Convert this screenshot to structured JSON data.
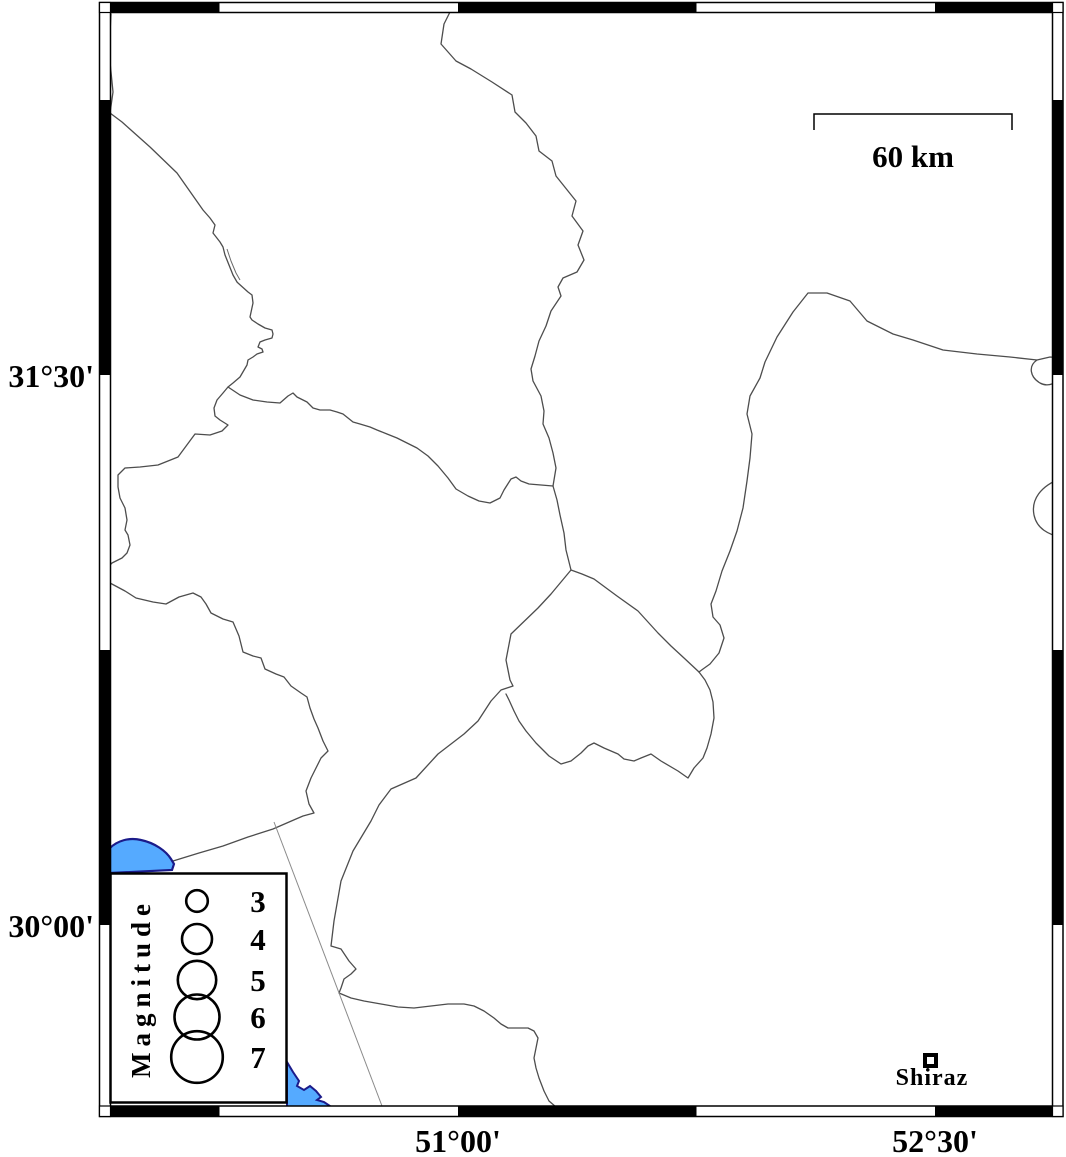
{
  "frame": {
    "lat_labels": [
      {
        "text": "31°30'"
      },
      {
        "text": "30°00'"
      }
    ],
    "lon_labels": [
      {
        "text": "51°00'"
      },
      {
        "text": "52°30'"
      }
    ]
  },
  "scale_bar": {
    "label": "60 km"
  },
  "legend": {
    "title": "Magnitude",
    "items": [
      {
        "magnitude": "3"
      },
      {
        "magnitude": "4"
      },
      {
        "magnitude": "5"
      },
      {
        "magnitude": "6"
      },
      {
        "magnitude": "7"
      }
    ]
  },
  "city": {
    "name": "Shiraz"
  },
  "colors": {
    "water": "#55aaff",
    "water_outline": "#1b1b8a",
    "boundary": "#4d4d4d",
    "fault_line": "#8a8a8a",
    "frame": "#000000",
    "background": "#ffffff"
  }
}
